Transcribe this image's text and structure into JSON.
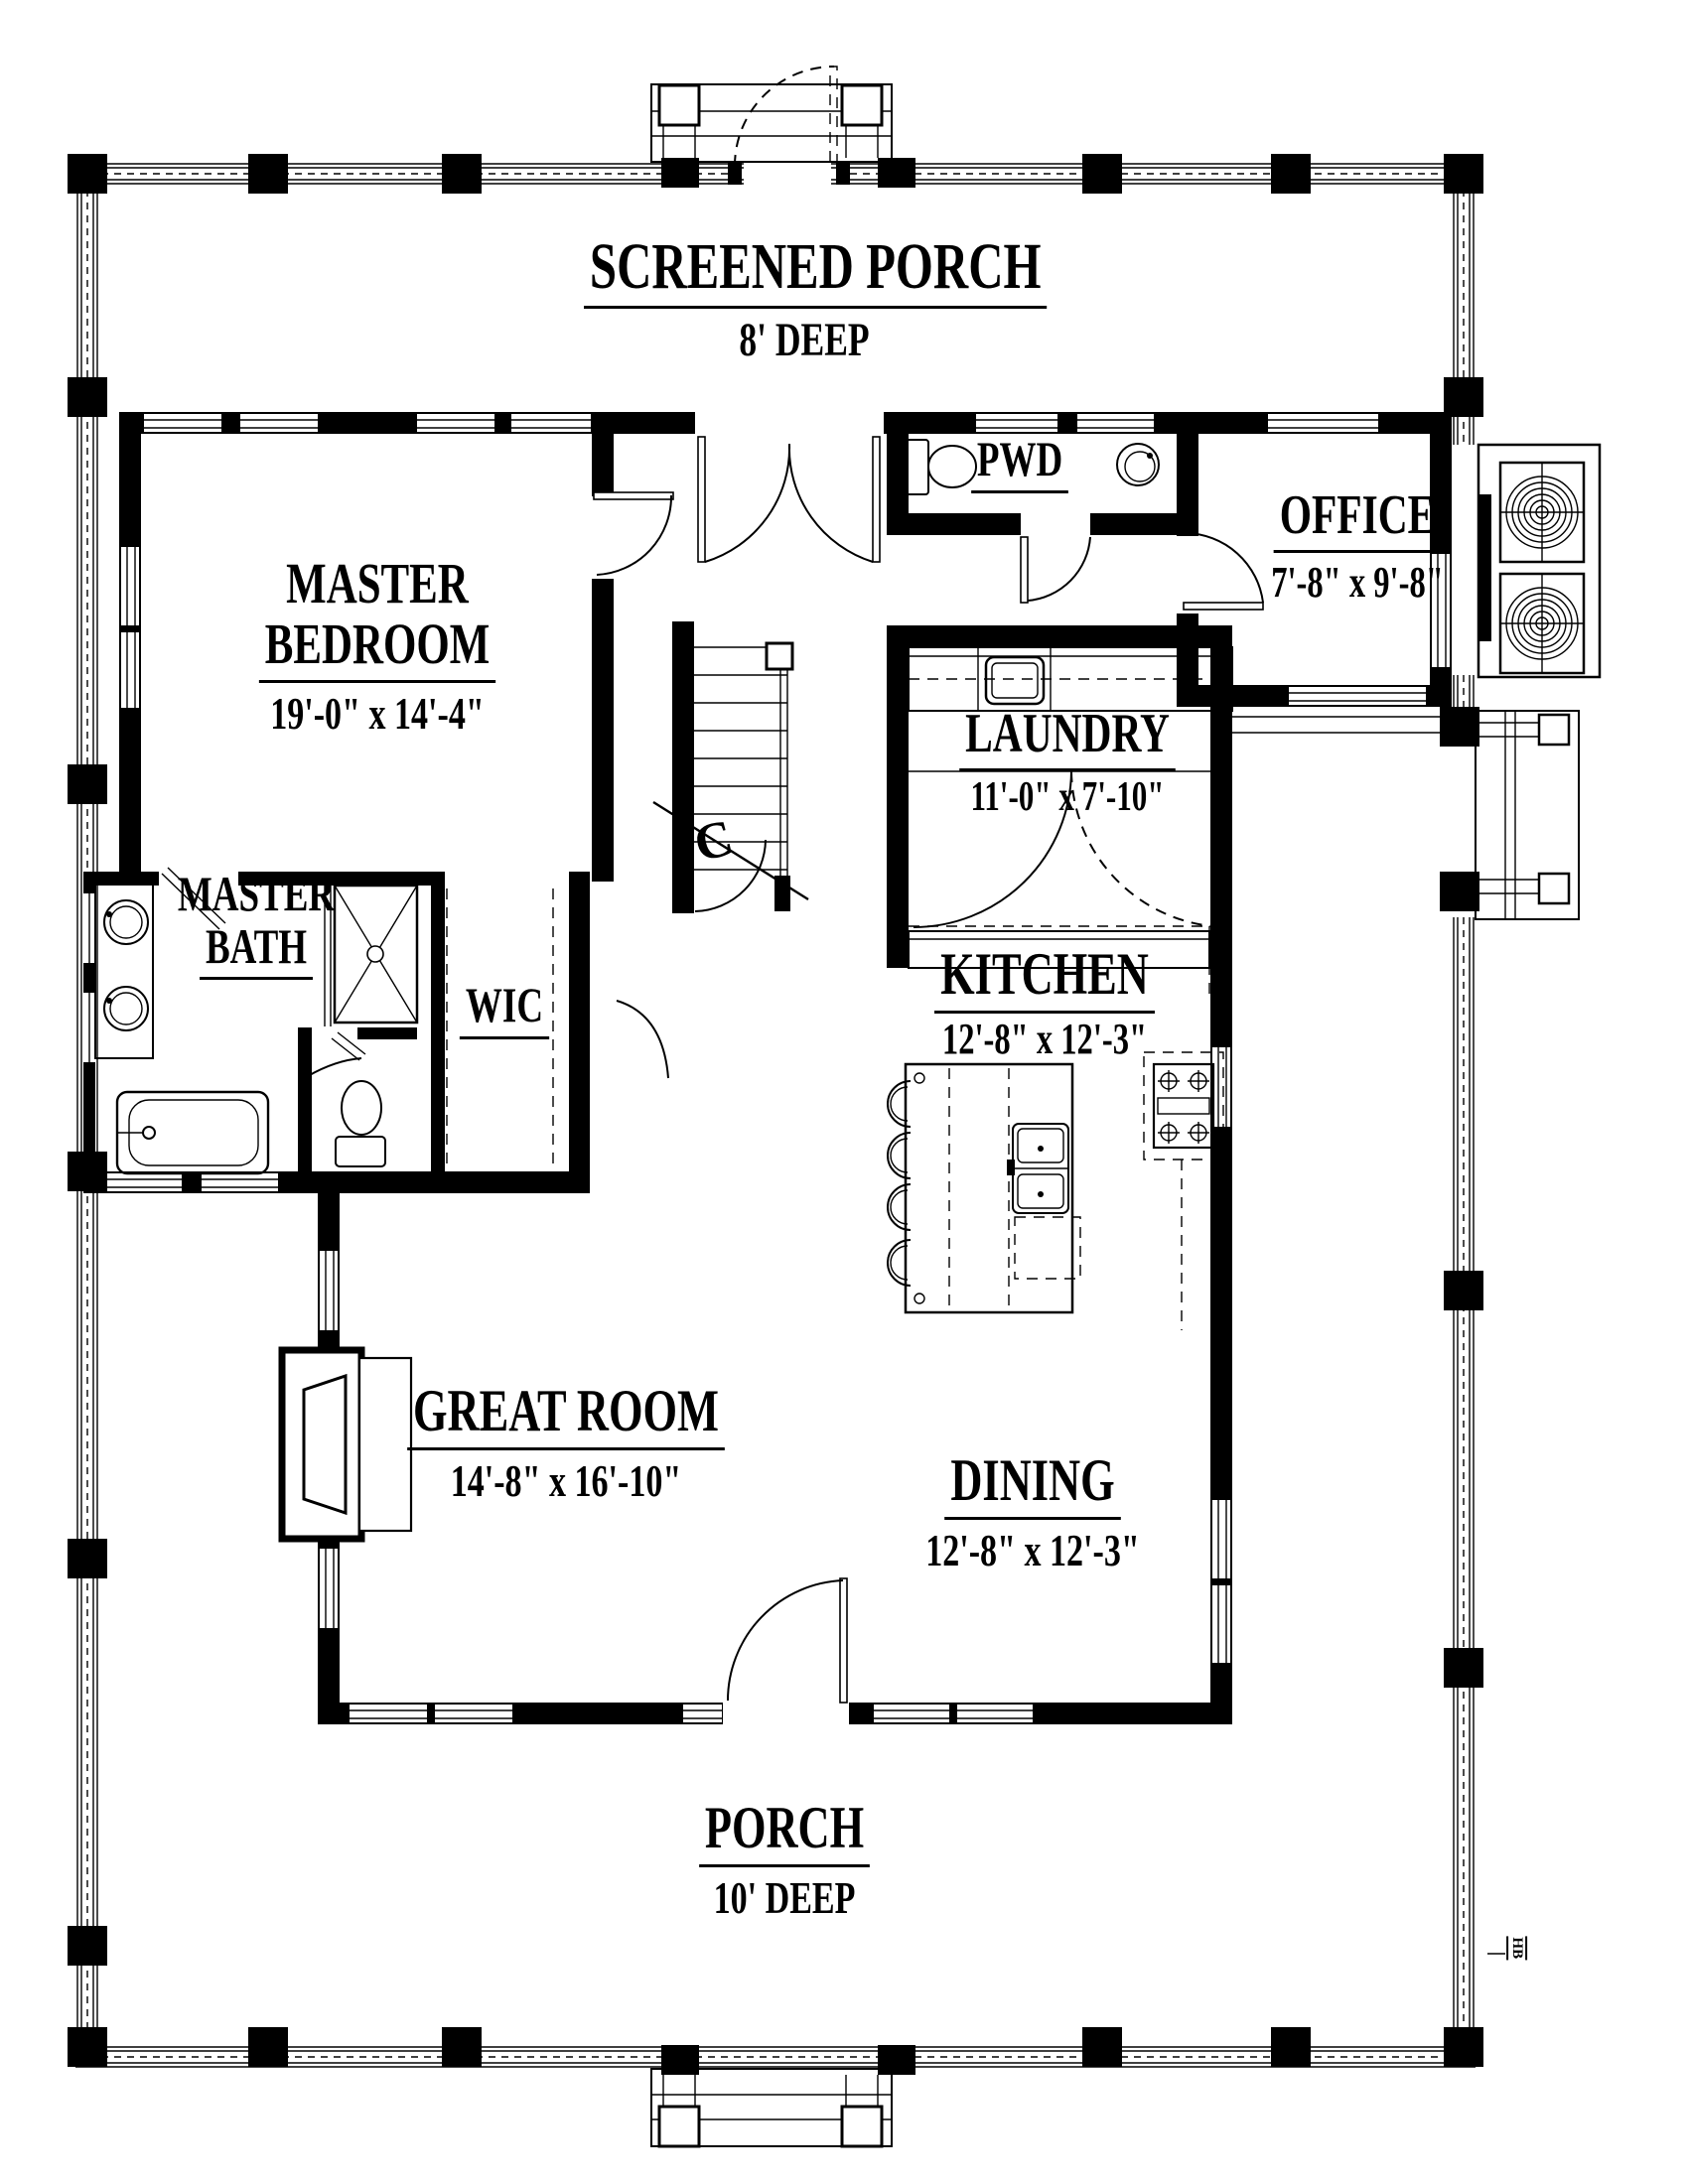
{
  "colors": {
    "ink": "#000000",
    "paper": "#ffffff"
  },
  "rooms": {
    "screened_porch": {
      "name": "SCREENED PORCH",
      "dims": "8' DEEP"
    },
    "master_bedroom": {
      "line1": "MASTER",
      "line2": "BEDROOM",
      "dims": "19'-0\" x 14'-4\""
    },
    "pwd": {
      "name": "PWD"
    },
    "office": {
      "name": "OFFICE",
      "dims": "7'-8\" x 9'-8\""
    },
    "laundry": {
      "name": "LAUNDRY",
      "dims": "11'-0\" x 7'-10\""
    },
    "master_bath": {
      "line1": "MASTER",
      "line2": "BATH"
    },
    "wic": {
      "name": "WIC"
    },
    "kitchen": {
      "name": "KITCHEN",
      "dims": "12'-8\" x 12'-3\""
    },
    "great_room": {
      "name": "GREAT ROOM",
      "dims": "14'-8\" x 16'-10\""
    },
    "dining": {
      "name": "DINING",
      "dims": "12'-8\" x 12'-3\""
    },
    "porch": {
      "name": "PORCH",
      "dims": "10' DEEP"
    }
  },
  "annotations": {
    "stair_section_mark": "C",
    "hose_bib": "HB"
  }
}
